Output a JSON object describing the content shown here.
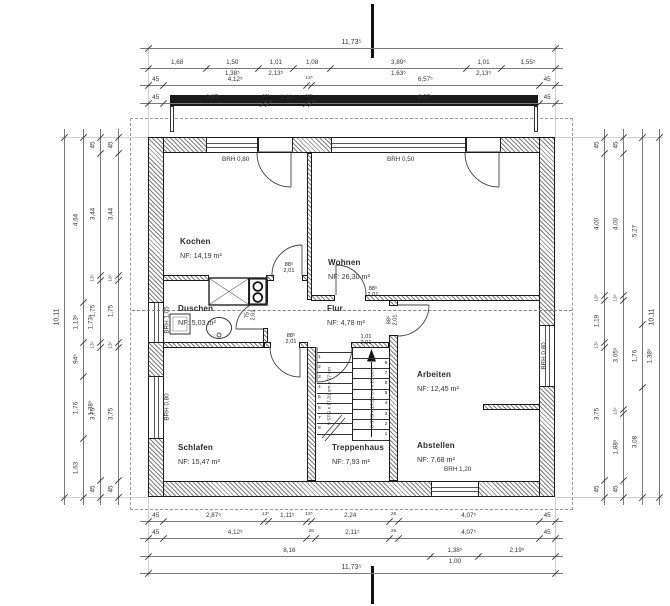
{
  "drawing": {
    "rooms": {
      "kochen": {
        "name": "Kochen",
        "area": "NF: 14,19 m²"
      },
      "wohnen": {
        "name": "Wohnen",
        "area": "NF: 26,30 m²"
      },
      "duschen": {
        "name": "Duschen",
        "area": "NF: 5,03 m²"
      },
      "flur": {
        "name": "Flur",
        "area": "NF: 4,78 m²"
      },
      "arbeiten": {
        "name": "Arbeiten",
        "area": "NF: 12,45 m²"
      },
      "schlafen": {
        "name": "Schlafen",
        "area": "NF: 15,47 m²"
      },
      "treppenhaus": {
        "name": "Treppenhaus",
        "area": "NF:   7,93 m²"
      },
      "abstellen": {
        "name": "Abstellen",
        "area": "NF: 7,68 m²"
      }
    },
    "sills": {
      "kochen_window": "BRH 0,80",
      "wohnen_window": "BRH 0,50",
      "duschen_window": "BRH 1,05",
      "schlafen_window": "BRH 0,80",
      "arbeiten_window": "BRH 0,80",
      "abstellen_window": "BRH 1,20"
    },
    "door_labels": {
      "kochen": [
        "88⁵",
        "2,01"
      ],
      "duschen": [
        "75",
        "2,01"
      ],
      "wohnen": [
        "88⁵",
        "2,01"
      ],
      "arbeiten": [
        "88⁵",
        "2,01"
      ],
      "schlafen": [
        "88⁵",
        "2,01"
      ],
      "treppenhaus": [
        "1,01",
        "2,01"
      ]
    },
    "stairs": {
      "left_label": "9 STG x 17,31 cm x 27 cm",
      "right_label": "8 STG x 17,31 cm x 25 cm",
      "left_numbers": [
        1,
        2,
        3,
        4,
        5,
        6,
        7,
        8
      ],
      "right_numbers": [
        8,
        7,
        6,
        5,
        4,
        3,
        2,
        1
      ]
    },
    "chains": {
      "t1": [
        {
          "t": "11,73⁵",
          "m": 11.735
        }
      ],
      "t2": [
        {
          "t": "1,68",
          "m": 1.68
        },
        {
          "t": "1,50",
          "m": 1.5,
          "b": "1,38⁵"
        },
        {
          "t": "1,01",
          "m": 1.01,
          "b": "2,13⁵"
        },
        {
          "t": "1,08",
          "m": 1.08
        },
        {
          "t": "3,89⁵",
          "m": 3.895,
          "b": "1,63⁵"
        },
        {
          "t": "1,01",
          "m": 1.01,
          "b": "2,13⁵"
        },
        {
          "t": "1,55⁵",
          "m": 1.555
        }
      ],
      "t3": [
        {
          "t": "45",
          "m": 0.45
        },
        {
          "t": "4,12⁵",
          "m": 4.125
        },
        {
          "t": "13⁵",
          "m": 0.135
        },
        {
          "t": "6,57⁵",
          "m": 6.575
        },
        {
          "t": "45",
          "m": 0.45
        }
      ],
      "t4": [
        {
          "t": "45",
          "m": 0.45
        },
        {
          "t": "2,87⁵",
          "m": 2.875
        },
        {
          "t": "13⁵",
          "m": 0.135
        },
        {
          "t": "1,11⁵",
          "m": 1.115
        },
        {
          "t": "13⁵",
          "m": 0.135
        },
        {
          "t": "6,57⁵",
          "m": 6.575
        },
        {
          "t": "45",
          "m": 0.45
        }
      ],
      "b1": [
        {
          "t": "45",
          "m": 0.45
        },
        {
          "t": "2,87⁵",
          "m": 2.875
        },
        {
          "t": "13⁵",
          "m": 0.135
        },
        {
          "t": "1,11⁵",
          "m": 1.115
        },
        {
          "t": "13⁵",
          "m": 0.135
        },
        {
          "t": "2,24",
          "m": 2.24
        },
        {
          "t": "26",
          "m": 0.26
        },
        {
          "t": "4,07⁵",
          "m": 4.075
        },
        {
          "t": "45",
          "m": 0.45
        }
      ],
      "b2": [
        {
          "t": "45",
          "m": 0.45
        },
        {
          "t": "4,12⁵",
          "m": 4.125
        },
        {
          "t": "26",
          "m": 0.26
        },
        {
          "t": "2,11⁵",
          "m": 2.115
        },
        {
          "t": "26",
          "m": 0.26
        },
        {
          "t": "4,07⁵",
          "m": 4.075
        },
        {
          "t": "45",
          "m": 0.45
        }
      ],
      "b3": [
        {
          "t": "8,16",
          "m": 8.16
        },
        {
          "t": "1,38⁵",
          "m": 1.385,
          "b": "1,00"
        },
        {
          "t": "2,19⁵",
          "m": 2.195
        }
      ],
      "b4": [
        {
          "t": "11,73⁵",
          "m": 11.735
        }
      ],
      "l1": [
        {
          "t": "10,11",
          "m": 10.11
        }
      ],
      "l2": [
        {
          "t": "4,64",
          "m": 4.64
        },
        {
          "t": "1,13⁵",
          "m": 1.135,
          "b": "1,73⁵"
        },
        {
          "t": "94⁵",
          "m": 0.945
        },
        {
          "t": "1,76",
          "m": 1.76,
          "b": "1,38⁵"
        },
        {
          "t": "1,63",
          "m": 1.63
        }
      ],
      "l3": [
        {
          "t": "45",
          "m": 0.45
        },
        {
          "t": "3,44",
          "m": 3.44
        },
        {
          "t": "13⁵",
          "m": 0.135
        },
        {
          "t": "1,75",
          "m": 1.75
        },
        {
          "t": "13⁵",
          "m": 0.135
        },
        {
          "t": "3,75",
          "m": 3.75
        },
        {
          "t": "45",
          "m": 0.45
        }
      ],
      "l4": [
        {
          "t": "45",
          "m": 0.45
        },
        {
          "t": "3,44",
          "m": 3.44
        },
        {
          "t": "13⁵",
          "m": 0.135
        },
        {
          "t": "1,75",
          "m": 1.75
        },
        {
          "t": "13⁵",
          "m": 0.135
        },
        {
          "t": "3,75",
          "m": 3.75
        },
        {
          "t": "45",
          "m": 0.45
        }
      ],
      "r1": [
        {
          "t": "45",
          "m": 0.45
        },
        {
          "t": "4,00",
          "m": 4.0
        },
        {
          "t": "13⁵",
          "m": 0.135
        },
        {
          "t": "1,19",
          "m": 1.19
        },
        {
          "t": "13⁵",
          "m": 0.135
        },
        {
          "t": "3,75",
          "m": 3.75
        },
        {
          "t": "45",
          "m": 0.45
        }
      ],
      "r2": [
        {
          "t": "45",
          "m": 0.45
        },
        {
          "t": "4,00",
          "m": 4.0
        },
        {
          "t": "13⁵",
          "m": 0.135
        },
        {
          "t": "3,05⁵",
          "m": 3.055
        },
        {
          "t": "13⁵",
          "m": 0.135
        },
        {
          "t": "1,88⁵",
          "m": 1.885
        },
        {
          "t": "45",
          "m": 0.45
        }
      ],
      "r3": [
        {
          "t": "5,27",
          "m": 5.27
        },
        {
          "t": "1,76",
          "m": 1.76,
          "b": "1,38⁵"
        },
        {
          "t": "3,08",
          "m": 3.08
        }
      ],
      "r4": [
        {
          "t": "10,11",
          "m": 10.11
        }
      ]
    }
  }
}
